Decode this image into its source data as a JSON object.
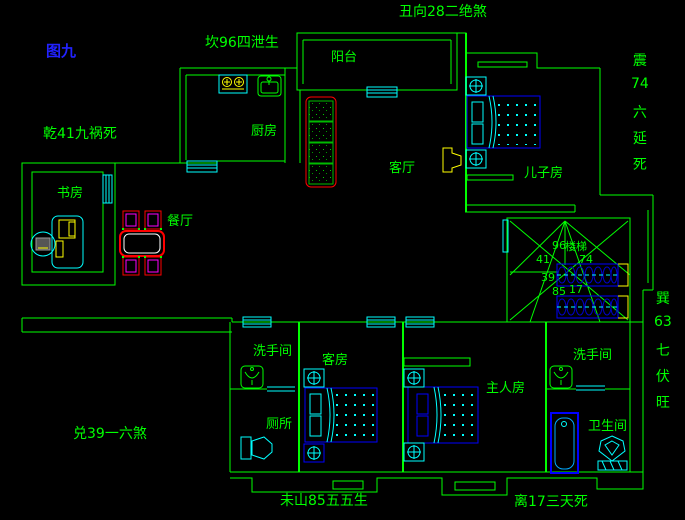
{
  "figure_label": "图九",
  "compass": {
    "top_left": "坎96四泄生",
    "top_center": "丑向28二绝煞",
    "left_upper": "乾41九祸死",
    "left_lower": "兑39一六煞",
    "bottom_left": "未山85五五生",
    "bottom_right": "离17三天死",
    "right_upper": [
      "震",
      "74",
      "六",
      "延",
      "死"
    ],
    "right_lower": [
      "巽",
      "63",
      "七",
      "伏",
      "旺"
    ]
  },
  "rooms": {
    "balcony": "阳台",
    "kitchen": "厨房",
    "living_room": "客厅",
    "son_room": "儿子房",
    "study": "书房",
    "dining": "餐厅",
    "washroom_left": "洗手间",
    "toilet": "厕所",
    "guest_room": "客房",
    "master_room": "主人房",
    "washroom_right": "洗手间",
    "bathroom": "卫生间",
    "stairs": "楼梯"
  },
  "stair_numbers": {
    "top": "96",
    "upper_left": "41",
    "upper_right": "74",
    "left": "39",
    "lower_left": "85",
    "lower_right": "17"
  },
  "palette": {
    "background": "#000000",
    "wall_green": "#00ff00",
    "window_cyan": "#00ffff",
    "furniture_blue": "#0000ff",
    "accent_yellow": "#ffff00",
    "accent_red": "#ff0000",
    "accent_magenta": "#ff00ff",
    "figure_label_blue": "#2222ff",
    "table_inner_white": "#ffffff"
  }
}
